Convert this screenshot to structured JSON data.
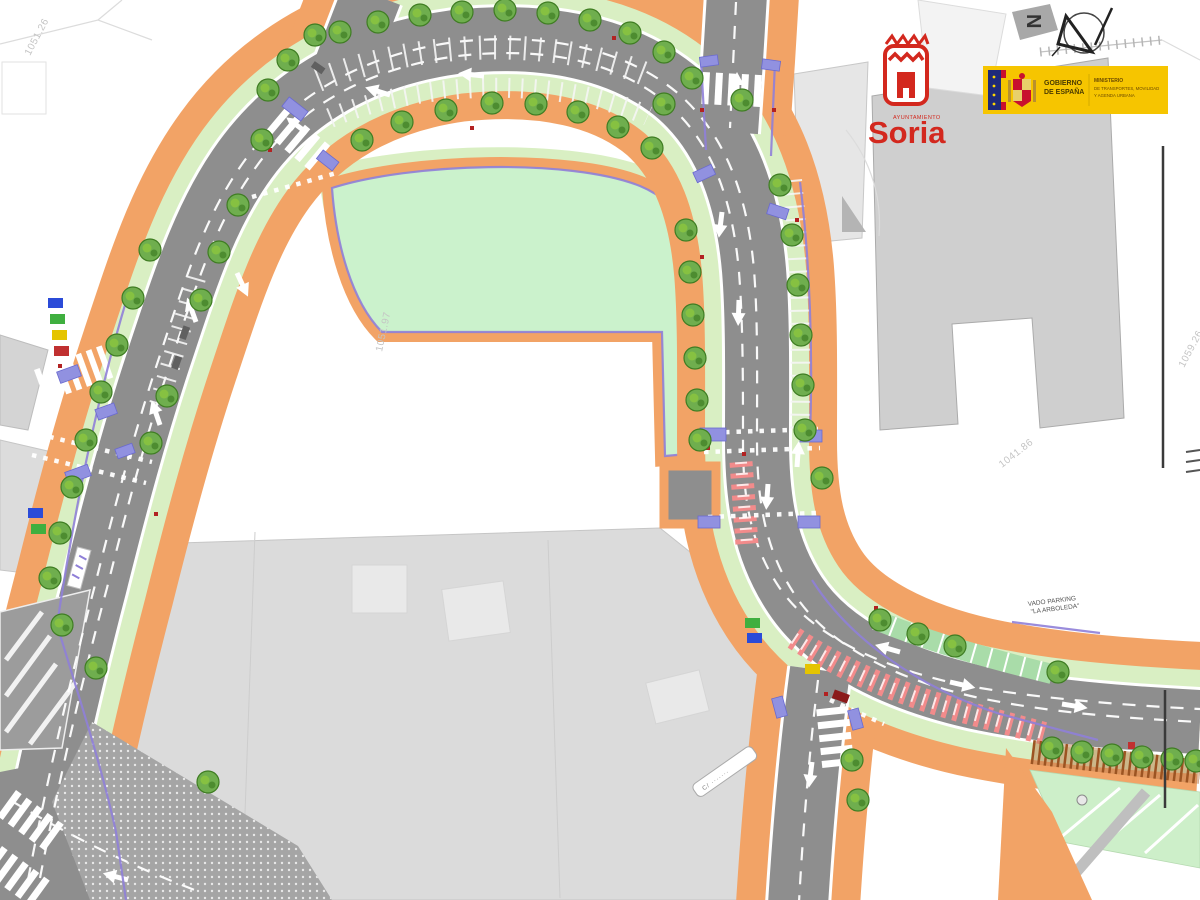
{
  "map": {
    "north_letter": "N",
    "street_sign": "C/ ·······",
    "vado": {
      "line1": "VADO PARKING",
      "line2": "\"LA ARBOLEDA\""
    },
    "elevations": [
      "1051.26",
      "1051.97",
      "1041.86",
      "1059.26"
    ]
  },
  "logos": {
    "soria": {
      "municipality_small": "AYUNTAMIENTO",
      "name": "Soria"
    },
    "gobierno": {
      "line1": "GOBIERNO",
      "line2": "DE ESPAÑA",
      "ministry1": "MINISTERIO",
      "ministry2": "DE TRANSPORTES, MOVILIDAD",
      "ministry3": "Y AGENDA URBANA"
    }
  },
  "colors": {
    "road_gray": "#8E8E8E",
    "sidewalk_orange": "#F2A366",
    "park_mint": "#CBF2CC",
    "verge_green": "#D9EFC3",
    "tree_green": "#6FAE4E",
    "curb_blue": "#9191E0",
    "bike_purple": "#8F7FD8",
    "hatch_red": "#F28B8B",
    "soria_red": "#D3281E",
    "gov_yellow": "#F6C500",
    "gov_blue": "#1F2A7A"
  }
}
